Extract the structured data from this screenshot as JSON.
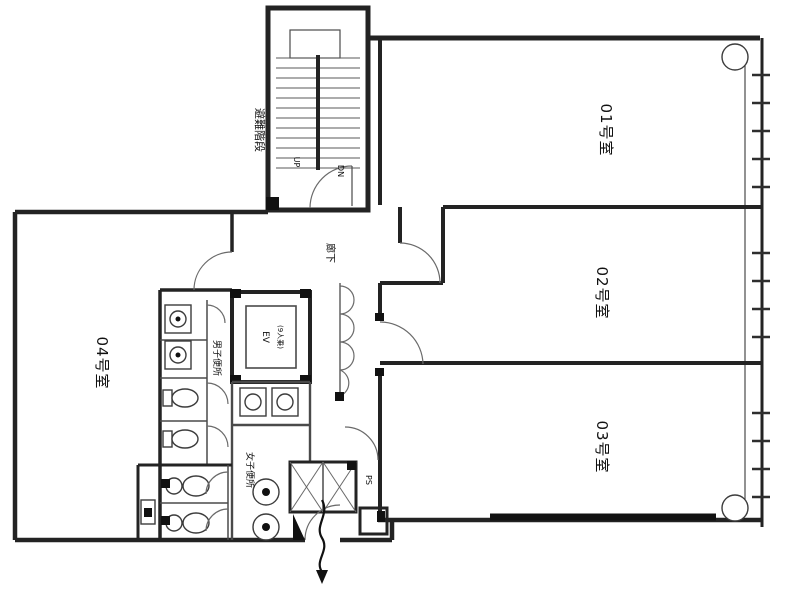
{
  "drawing": {
    "type": "floor-plan",
    "background_color": "#ffffff",
    "line_color": "#232323"
  },
  "labels": {
    "room1": "01号室",
    "room2": "02号室",
    "room3": "03号室",
    "room4": "04号室",
    "stairs": "避難階段",
    "corridor": "廊下",
    "elevator": "EV",
    "elevator_capacity": "(9人乗)",
    "mens_toilet": "男子便所",
    "womens_toilet": "女子便所",
    "pipe_shaft": "PS",
    "stair_up": "UP",
    "stair_down": "DN"
  }
}
